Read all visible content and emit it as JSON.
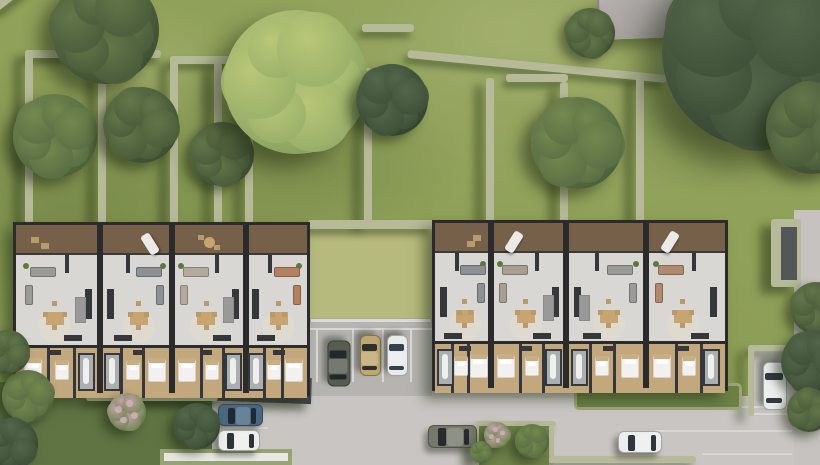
{
  "scene": {
    "title": "aerial-render-residential-site-plan",
    "canvas": {
      "w": 820,
      "h": 465
    },
    "palette": {
      "grass_base": "#90a159",
      "grass_courtyard": "#b6ba7c",
      "grass_wild": "#5f7343",
      "hedge": "#b7ba99",
      "pavement_light": "#c9c5c2",
      "pavement_lot": "#b6b4b1",
      "wall_dark": "#2b2b2d",
      "floor_interior": "#d8d7d4",
      "floor_wood": "#c3a87e",
      "deck_wood": "#78604615",
      "tones": {
        "dark": [
          "#4d5e3c",
          "#64784a",
          "#33412a"
        ],
        "deep": [
          "#41523a",
          "#55684a",
          "#2c392a"
        ],
        "mid": [
          "#5d7146",
          "#75894f",
          "#42522f"
        ],
        "light": [
          "#9cb26b",
          "#bac878",
          "#7b9352"
        ],
        "flower": [
          "#7d8a5e",
          "#c0a3a8",
          "#5c6b45"
        ]
      }
    },
    "items": [
      {
        "kind": "rect",
        "name": "upper-lawn",
        "x": 0,
        "y": 0,
        "w": 820,
        "h": 230,
        "cls": "mottle"
      },
      {
        "kind": "rect",
        "name": "courtyard-lawn",
        "x": 310,
        "y": 227,
        "w": 122,
        "h": 96,
        "fill": "#b6ba7c",
        "cls": "mottle-light"
      },
      {
        "kind": "rect",
        "name": "courtyard-retaining-wall",
        "x": 310,
        "y": 318,
        "w": 122,
        "h": 8,
        "fill": "#dcdbd8",
        "border": "1px solid #a8a6a3"
      },
      {
        "kind": "rect",
        "name": "left-garden",
        "x": 0,
        "y": 382,
        "w": 218,
        "h": 83,
        "fill": "#5f7343",
        "cls": "mottle-dark"
      },
      {
        "kind": "rect",
        "name": "parking-lot-pavement",
        "x": 308,
        "y": 322,
        "w": 124,
        "h": 78,
        "fill": "#b6b4b1"
      },
      {
        "kind": "rect",
        "name": "street-pavement",
        "x": 212,
        "y": 396,
        "w": 608,
        "h": 69,
        "fill": "#c9c5c2",
        "cls": "mottle"
      },
      {
        "kind": "rect",
        "name": "right-apron-pavement",
        "x": 432,
        "y": 382,
        "w": 146,
        "h": 16,
        "fill": "#c2bfbc"
      },
      {
        "kind": "rect",
        "name": "right-bay-pavement",
        "x": 748,
        "y": 350,
        "w": 50,
        "h": 66,
        "fill": "#c6c3c0"
      },
      {
        "kind": "rect",
        "name": "right-road",
        "x": 794,
        "y": 210,
        "w": 26,
        "h": 255,
        "fill": "#c6c2bf"
      },
      {
        "kind": "rect",
        "name": "parking-line-top",
        "x": 310,
        "y": 328,
        "w": 122,
        "h": 2,
        "fill": "#dad8d5"
      },
      {
        "kind": "rect",
        "name": "parking-line-1",
        "x": 316,
        "y": 330,
        "w": 2,
        "h": 52,
        "fill": "#dad8d5"
      },
      {
        "kind": "rect",
        "name": "parking-line-2",
        "x": 352,
        "y": 330,
        "w": 2,
        "h": 52,
        "fill": "#dad8d5"
      },
      {
        "kind": "rect",
        "name": "parking-line-3",
        "x": 382,
        "y": 330,
        "w": 2,
        "h": 52,
        "fill": "#dad8d5"
      },
      {
        "kind": "rect",
        "name": "parking-line-4",
        "x": 410,
        "y": 330,
        "w": 2,
        "h": 52,
        "fill": "#dad8d5"
      },
      {
        "kind": "rect",
        "name": "west-bay-line-1",
        "x": 213,
        "y": 400,
        "w": 55,
        "h": 2,
        "fill": "#d8d5d2"
      },
      {
        "kind": "rect",
        "name": "west-bay-line-2",
        "x": 213,
        "y": 427,
        "w": 55,
        "h": 2,
        "fill": "#d8d5d2"
      },
      {
        "kind": "rect",
        "name": "west-bay-line-3",
        "x": 213,
        "y": 451,
        "w": 55,
        "h": 2,
        "fill": "#d8d5d2"
      },
      {
        "kind": "rect",
        "name": "east-bay-line",
        "x": 751,
        "y": 413,
        "w": 45,
        "h": 2,
        "fill": "#d8d5d2"
      },
      {
        "kind": "rect",
        "name": "street-dash-1",
        "x": 688,
        "y": 406,
        "w": 104,
        "h": 2,
        "fill": "rgba(255,255,255,0.35)"
      },
      {
        "kind": "rect",
        "name": "street-dash-2",
        "x": 655,
        "y": 430,
        "w": 137,
        "h": 2,
        "fill": "rgba(255,255,255,0.30)"
      },
      {
        "kind": "rect",
        "name": "street-dash-3",
        "x": 702,
        "y": 453,
        "w": 90,
        "h": 2,
        "fill": "rgba(255,255,255,0.28)"
      },
      {
        "kind": "rect",
        "name": "entry-canopy",
        "x": 108,
        "y": 371,
        "w": 204,
        "h": 26,
        "rot": 2,
        "grad": "linear-gradient(180deg,#54565a,#3e4043)",
        "shadow": "-6px 7px 8px rgba(30,40,20,0.40)"
      },
      {
        "kind": "hedge",
        "name": "hedge-nw-top",
        "x": 25,
        "y": 50,
        "w": 136,
        "h": 8
      },
      {
        "kind": "hedge",
        "name": "hedge-w-vert-1",
        "x": 25,
        "y": 50,
        "w": 8,
        "h": 174
      },
      {
        "kind": "hedge",
        "name": "hedge-w-vert-2",
        "x": 98,
        "y": 50,
        "w": 8,
        "h": 174
      },
      {
        "kind": "hedge",
        "name": "hedge-w-top-2",
        "x": 170,
        "y": 56,
        "w": 64,
        "h": 8
      },
      {
        "kind": "hedge",
        "name": "hedge-w-vert-3",
        "x": 170,
        "y": 56,
        "w": 8,
        "h": 168
      },
      {
        "kind": "hedge",
        "name": "hedge-w-vert-4",
        "x": 214,
        "y": 62,
        "w": 8,
        "h": 162
      },
      {
        "kind": "hedge",
        "name": "hedge-w-vert-5",
        "x": 245,
        "y": 106,
        "w": 8,
        "h": 118
      },
      {
        "kind": "hedge",
        "name": "hedge-n-top-right",
        "x": 362,
        "y": 24,
        "w": 52,
        "h": 8
      },
      {
        "kind": "hedge",
        "name": "hedge-n-vert",
        "x": 364,
        "y": 68,
        "w": 8,
        "h": 156
      },
      {
        "kind": "hedge",
        "name": "hedge-diagonal",
        "x": 408,
        "y": 50,
        "w": 260,
        "h": 8,
        "rot": 5.5
      },
      {
        "kind": "hedge",
        "name": "hedge-e-vert-1",
        "x": 486,
        "y": 78,
        "w": 8,
        "h": 146
      },
      {
        "kind": "hedge",
        "name": "hedge-e-top",
        "x": 506,
        "y": 74,
        "w": 62,
        "h": 8
      },
      {
        "kind": "hedge",
        "name": "hedge-e-vert-2",
        "x": 560,
        "y": 82,
        "w": 8,
        "h": 142
      },
      {
        "kind": "hedge",
        "name": "hedge-e-vert-3",
        "x": 636,
        "y": 74,
        "w": 8,
        "h": 150
      },
      {
        "kind": "hedge",
        "name": "hedge-courtyard-top",
        "x": 308,
        "y": 220,
        "w": 126,
        "h": 9
      },
      {
        "kind": "hedge",
        "name": "hedge-canopy-edge",
        "x": 86,
        "y": 394,
        "w": 132,
        "h": 7
      },
      {
        "kind": "hedge",
        "name": "hedge-garden-top",
        "x": 475,
        "y": 421,
        "w": 81,
        "h": 6
      },
      {
        "kind": "hedge",
        "name": "hedge-garden-left",
        "x": 475,
        "y": 421,
        "w": 6,
        "h": 44
      },
      {
        "kind": "hedge",
        "name": "hedge-garden-right",
        "x": 548,
        "y": 427,
        "w": 6,
        "h": 38
      },
      {
        "kind": "hedge",
        "name": "hedge-street-bottom",
        "x": 548,
        "y": 456,
        "w": 148,
        "h": 7
      },
      {
        "kind": "hedge",
        "name": "hedge-bay-top",
        "x": 748,
        "y": 345,
        "w": 50,
        "h": 6
      },
      {
        "kind": "hedge",
        "name": "hedge-bay-left",
        "x": 748,
        "y": 345,
        "w": 6,
        "h": 71
      },
      {
        "kind": "hedge",
        "name": "hedge-path-border",
        "x": 771,
        "y": 219,
        "w": 30,
        "h": 68
      },
      {
        "kind": "rect",
        "name": "garden-path",
        "x": 781,
        "y": 227,
        "w": 16,
        "h": 53,
        "fill": "#54575a"
      },
      {
        "kind": "hedge",
        "name": "hedge-nw-corner-diag",
        "x": -8,
        "y": 6,
        "w": 42,
        "h": 8,
        "rot": -38
      },
      {
        "kind": "rect",
        "name": "south-garden-lawn",
        "x": 479,
        "y": 426,
        "w": 70,
        "h": 39,
        "fill": "#6e8149",
        "cls": "mottle-dark"
      },
      {
        "kind": "rect",
        "name": "east-front-lawn",
        "x": 574,
        "y": 383,
        "w": 168,
        "h": 27,
        "fill": "#6d8046",
        "cls": "mottle-dark",
        "border": "3px solid #9ca577",
        "r": 5
      },
      {
        "kind": "rect",
        "name": "terrace-pad",
        "x": 160,
        "y": 449,
        "w": 132,
        "h": 16,
        "fill": "#e8e7e4",
        "border": "4px solid #97a374"
      }
    ],
    "buildings": [
      {
        "name": "west-building",
        "x": 13,
        "y": 222,
        "w": 297,
        "deckH": 30,
        "livingH": 90,
        "bedH": 50,
        "dividers": [
          84,
          156,
          230
        ],
        "units": [
          {
            "deck": "chairs",
            "sofa": "#9a9a97",
            "mirror": false,
            "stairs": true
          },
          {
            "deck": "lounger",
            "sofa": "#8d9195",
            "mirror": true,
            "stairs": false
          },
          {
            "deck": "table",
            "sofa": "#b3aa9c",
            "mirror": false,
            "stairs": true
          },
          {
            "deck": "none",
            "sofa": "#b5805f",
            "mirror": true,
            "stairs": false
          }
        ]
      },
      {
        "name": "east-building",
        "x": 432,
        "y": 220,
        "w": 296,
        "deckH": 30,
        "livingH": 88,
        "bedH": 49,
        "dividers": [
          56,
          131,
          211
        ],
        "units": [
          {
            "deck": "chairs",
            "sofa": "#8d9195",
            "mirror": true,
            "stairs": false
          },
          {
            "deck": "lounger",
            "sofa": "#a89f92",
            "mirror": false,
            "stairs": true
          },
          {
            "deck": "none",
            "sofa": "#9a9a98",
            "mirror": true,
            "stairs": true
          },
          {
            "deck": "lounger",
            "sofa": "#b08a6d",
            "mirror": false,
            "stairs": false
          }
        ]
      }
    ],
    "furniture": {
      "deck": {
        "chairs": [
          {
            "t": "deckChair",
            "fx": 0.2,
            "dy": 8,
            "w": 8,
            "h": 6
          },
          {
            "t": "deckChair",
            "fx": 0.33,
            "dy": 14,
            "w": 8,
            "h": 6
          }
        ],
        "lounger": [
          {
            "t": "lounger",
            "fx": 0.28,
            "dy": 4,
            "w": 10,
            "h": 22,
            "rot": 32
          }
        ],
        "table": [
          {
            "t": "deckTable",
            "fx": 0.5,
            "dy": 8,
            "d": 11
          },
          {
            "t": "deckChair",
            "fx": 0.38,
            "dy": 6,
            "w": 6,
            "h": 5
          },
          {
            "t": "deckChair",
            "fx": 0.62,
            "dy": 16,
            "w": 6,
            "h": 5
          }
        ],
        "none": []
      },
      "living": [
        {
          "t": "plant",
          "fx": 0.08,
          "dy": 8,
          "d": 6
        },
        {
          "t": "stub",
          "fx": 0.62,
          "dy": 0,
          "w": 4,
          "h": 18
        },
        {
          "t": "sofa",
          "fx": 0.3,
          "dy": 12,
          "w": 26,
          "h": 10
        },
        {
          "t": "sofaSide",
          "fx": 0.12,
          "dy": 30,
          "w": 8,
          "h": 20
        },
        {
          "t": "rug",
          "fx": 0.46,
          "dy": 56,
          "d": 32
        },
        {
          "t": "table",
          "fx": 0.46,
          "dy": 57,
          "w": 18,
          "h": 13
        },
        {
          "t": "chair",
          "fx": 0.34,
          "dy": 57,
          "w": 5,
          "h": 5
        },
        {
          "t": "chair",
          "fx": 0.58,
          "dy": 57,
          "w": 5,
          "h": 5
        },
        {
          "t": "chair",
          "fx": 0.46,
          "dy": 46,
          "w": 5,
          "h": 5
        },
        {
          "t": "chair",
          "fx": 0.46,
          "dy": 70,
          "w": 5,
          "h": 5
        },
        {
          "t": "kitchen",
          "fx": 0.9,
          "dy": 34,
          "w": 7,
          "h": 30
        },
        {
          "t": "counter",
          "fx": 0.7,
          "dy": 80,
          "w": 18,
          "h": 6
        }
      ],
      "bed": [
        {
          "t": "wallV",
          "fx": 0.38,
          "dy": 0,
          "w": 3,
          "hFull": true
        },
        {
          "t": "wallV",
          "fx": 0.72,
          "dy": 0,
          "w": 3,
          "hFull": true
        },
        {
          "t": "bed",
          "fx": 0.17,
          "dy": 10,
          "w": 18,
          "h": 24
        },
        {
          "t": "bed",
          "fx": 0.55,
          "dy": 12,
          "w": 14,
          "h": 20
        },
        {
          "t": "bath",
          "fx": 0.87,
          "dy": 5,
          "w": 17,
          "hFull": true,
          "pad": 12
        },
        {
          "t": "wardrobe",
          "fx": 0.46,
          "dy": 2,
          "w": 12,
          "h": 5
        }
      ],
      "stairs": {
        "t": "stairs",
        "fx": 0.8,
        "dy": 42,
        "w": 11,
        "h": 26
      }
    },
    "cars": [
      {
        "name": "car-dark-olive",
        "cx": 339,
        "cy": 363,
        "len": 46,
        "wid": 23,
        "rot": 90,
        "body": "#575c50",
        "glass": "#23282c"
      },
      {
        "name": "car-tan",
        "cx": 370,
        "cy": 355,
        "len": 41,
        "wid": 21,
        "rot": 90,
        "body": "#c0a770",
        "glass": "#2b2f33"
      },
      {
        "name": "car-white-lot",
        "cx": 397,
        "cy": 355,
        "len": 41,
        "wid": 21,
        "rot": 90,
        "body": "#e9ebeb",
        "glass": "#33414e"
      },
      {
        "name": "car-blue",
        "cx": 240,
        "cy": 415,
        "len": 45,
        "wid": 22,
        "rot": 0,
        "body": "#4a6781",
        "glass": "#1f2933"
      },
      {
        "name": "car-white-west",
        "cx": 239,
        "cy": 440,
        "len": 42,
        "wid": 21,
        "rot": 0,
        "body": "#ededec",
        "glass": "#2e3338"
      },
      {
        "name": "car-olive-street",
        "cx": 452,
        "cy": 436,
        "len": 49,
        "wid": 23,
        "rot": 0,
        "body": "#75796c",
        "glass": "#272b2e"
      },
      {
        "name": "car-white-street",
        "cx": 640,
        "cy": 442,
        "len": 44,
        "wid": 22,
        "rot": 0,
        "body": "#eceeed",
        "glass": "#30363b"
      },
      {
        "name": "car-white-bay",
        "cx": 775,
        "cy": 386,
        "len": 48,
        "wid": 24,
        "rot": 90,
        "body": "#eaecec",
        "glass": "#343a40"
      }
    ],
    "neighbor_roof": {
      "name": "neighbor-roof",
      "x": 597,
      "y": 0,
      "w": 102,
      "h": 40,
      "rot": -2
    },
    "trees": [
      {
        "name": "tree-nw-large",
        "cx": 105,
        "cy": 30,
        "r": 54,
        "tone": "dark",
        "seed": 10
      },
      {
        "name": "tree-w-1",
        "cx": 55,
        "cy": 136,
        "r": 42,
        "tone": "mid",
        "seed": 40
      },
      {
        "name": "tree-w-2",
        "cx": 141,
        "cy": 125,
        "r": 38,
        "tone": "dark",
        "seed": 70
      },
      {
        "name": "tree-w-3",
        "cx": 222,
        "cy": 154,
        "r": 32,
        "tone": "dark",
        "seed": 20
      },
      {
        "name": "tree-center-light",
        "cx": 296,
        "cy": 82,
        "r": 72,
        "tone": "light",
        "seed": 0
      },
      {
        "name": "tree-center-bush",
        "cx": 392,
        "cy": 100,
        "r": 36,
        "tone": "deep",
        "seed": 50
      },
      {
        "name": "tree-n-small",
        "cx": 590,
        "cy": 33,
        "r": 25,
        "tone": "dark",
        "seed": 15
      },
      {
        "name": "tree-ne-mid",
        "cx": 577,
        "cy": 143,
        "r": 46,
        "tone": "mid",
        "seed": 65
      },
      {
        "name": "tree-ne-large",
        "cx": 757,
        "cy": 52,
        "r": 95,
        "tone": "deep",
        "seed": 30
      },
      {
        "name": "tree-e-mass",
        "cx": 812,
        "cy": 128,
        "r": 46,
        "tone": "dark",
        "seed": 80
      },
      {
        "name": "tree-e-road-1",
        "cx": 816,
        "cy": 308,
        "r": 26,
        "tone": "dark",
        "seed": 25
      },
      {
        "name": "tree-e-road-2",
        "cx": 813,
        "cy": 362,
        "r": 32,
        "tone": "deep",
        "seed": 55
      },
      {
        "name": "tree-e-road-3",
        "cx": 809,
        "cy": 410,
        "r": 22,
        "tone": "dark",
        "seed": 85
      },
      {
        "name": "tree-sw-round",
        "cx": 197,
        "cy": 426,
        "r": 23,
        "tone": "deep",
        "seed": 35
      },
      {
        "name": "bush-sw-flower",
        "cx": 127,
        "cy": 412,
        "r": 19,
        "tone": "flower",
        "seed": 5
      },
      {
        "name": "bush-w-edge-1",
        "cx": 28,
        "cy": 396,
        "r": 26,
        "tone": "mid",
        "seed": 45
      },
      {
        "name": "bush-w-edge-2",
        "cx": 8,
        "cy": 352,
        "r": 22,
        "tone": "dark",
        "seed": 75
      },
      {
        "name": "bush-w-edge-3",
        "cx": 12,
        "cy": 444,
        "r": 26,
        "tone": "deep",
        "seed": 95
      },
      {
        "name": "bush-garden-1",
        "cx": 532,
        "cy": 441,
        "r": 17,
        "tone": "mid",
        "seed": 12
      },
      {
        "name": "bush-garden-2",
        "cx": 497,
        "cy": 435,
        "r": 13,
        "tone": "flower",
        "seed": 60
      },
      {
        "name": "bush-garden-3",
        "cx": 481,
        "cy": 452,
        "r": 11,
        "tone": "mid",
        "seed": 90
      }
    ]
  }
}
